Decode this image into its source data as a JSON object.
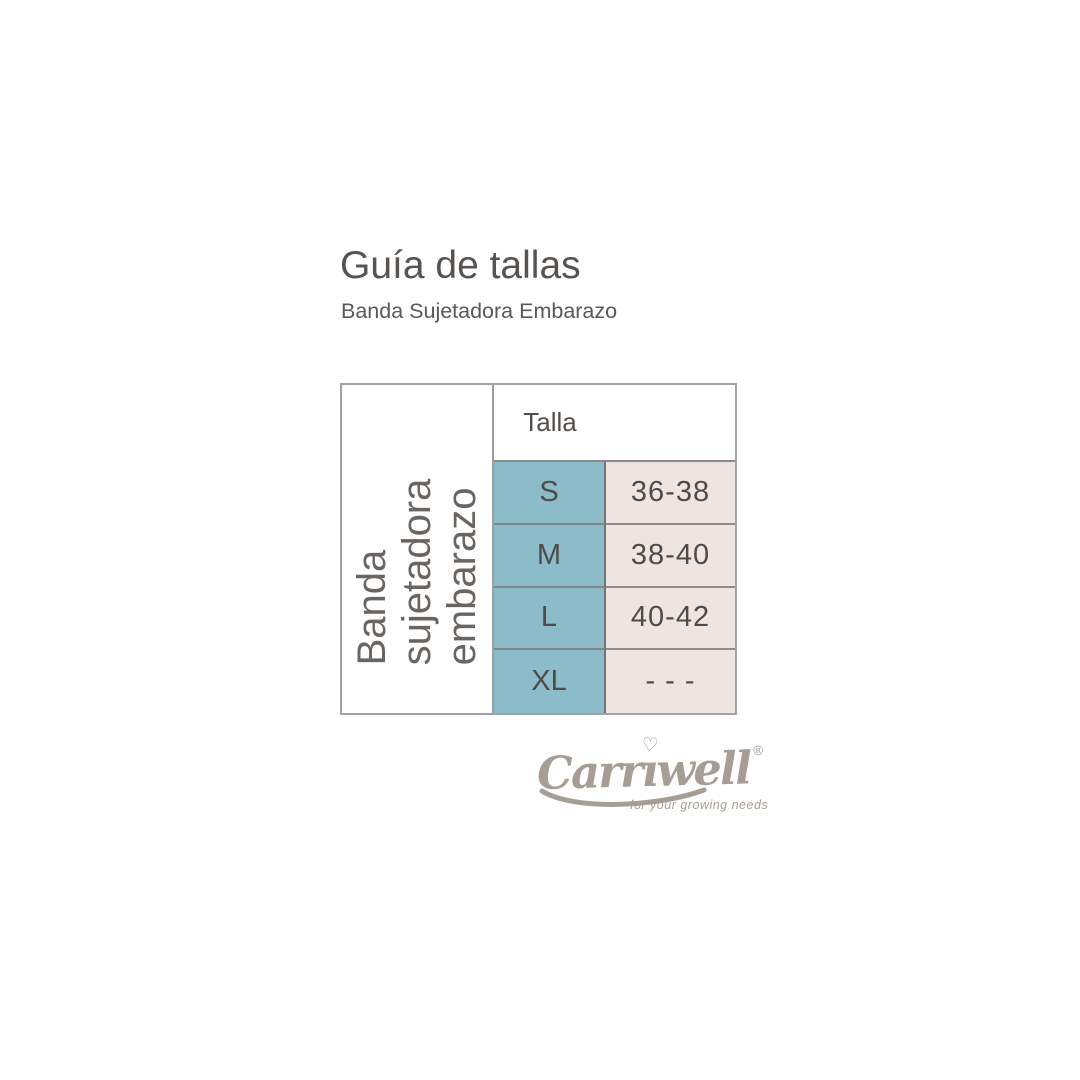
{
  "header": {
    "title": "Guía de tallas",
    "subtitle": "Banda Sujetadora Embarazo"
  },
  "table": {
    "vertical_label": {
      "full_text": "Banda sujetadora embarazo",
      "lines": [
        "Banda",
        "sujetadora",
        "embarazo"
      ]
    },
    "column_header": "Talla",
    "rows": [
      {
        "size": "S",
        "range": "36-38"
      },
      {
        "size": "M",
        "range": "38-40"
      },
      {
        "size": "L",
        "range": "40-42"
      },
      {
        "size": "XL",
        "range": "- - -"
      }
    ],
    "colors": {
      "size_cell_bg": "#8cbcca",
      "range_cell_bg": "#eee5e3",
      "border": "#8a8a8a",
      "text": "#4f4b49"
    }
  },
  "logo": {
    "brand": "Carriwell",
    "brand_prefix": "Carr",
    "brand_i": "ı",
    "brand_suffix": "well",
    "heart": "♡",
    "registered": "®",
    "tagline": "for your growing needs",
    "color": "#a69e95"
  },
  "chart_data": {
    "type": "table",
    "title": "Guía de tallas",
    "subtitle": "Banda Sujetadora Embarazo",
    "row_group_label": "Banda sujetadora embarazo",
    "columns": [
      "Talla",
      "Medida"
    ],
    "rows": [
      [
        "S",
        "36-38"
      ],
      [
        "M",
        "38-40"
      ],
      [
        "L",
        "40-42"
      ],
      [
        "XL",
        "- - -"
      ]
    ],
    "layout": "size guide table; size column teal, measurement column light pink, left vertical product label"
  }
}
